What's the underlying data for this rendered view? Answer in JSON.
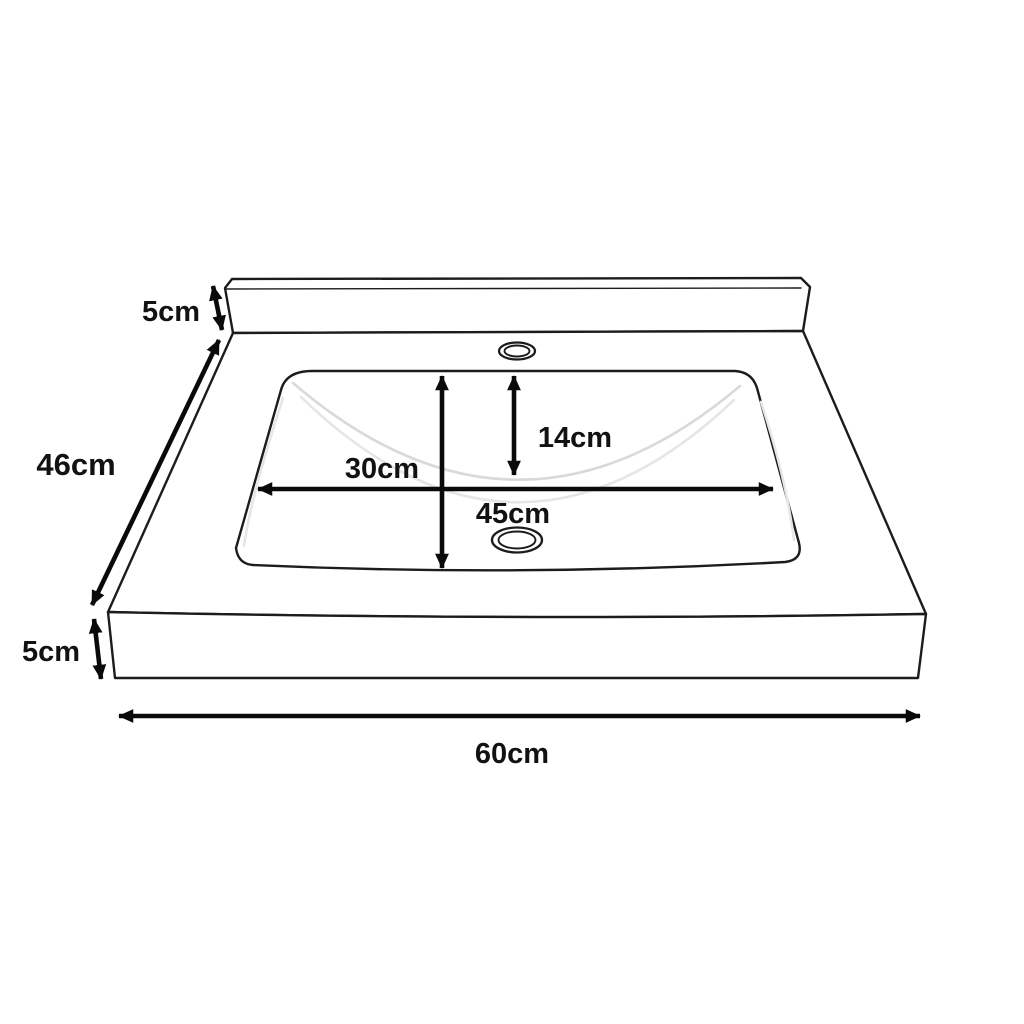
{
  "diagram": {
    "type": "dimension-diagram",
    "subject": "wash-basin-sink",
    "labels": {
      "backsplash_height": "5cm",
      "depth": "46cm",
      "apron_thickness": "5cm",
      "overall_width": "60cm",
      "basin_inner_depth": "30cm",
      "basin_bowl_depth": "14cm",
      "basin_inner_width": "45cm"
    },
    "colors": {
      "background": "#ffffff",
      "outline": "#1c1c1c",
      "dimension_lines": "#0a0a0a",
      "label_text": "#121212",
      "interior_contour": "#d9d9d9"
    }
  }
}
